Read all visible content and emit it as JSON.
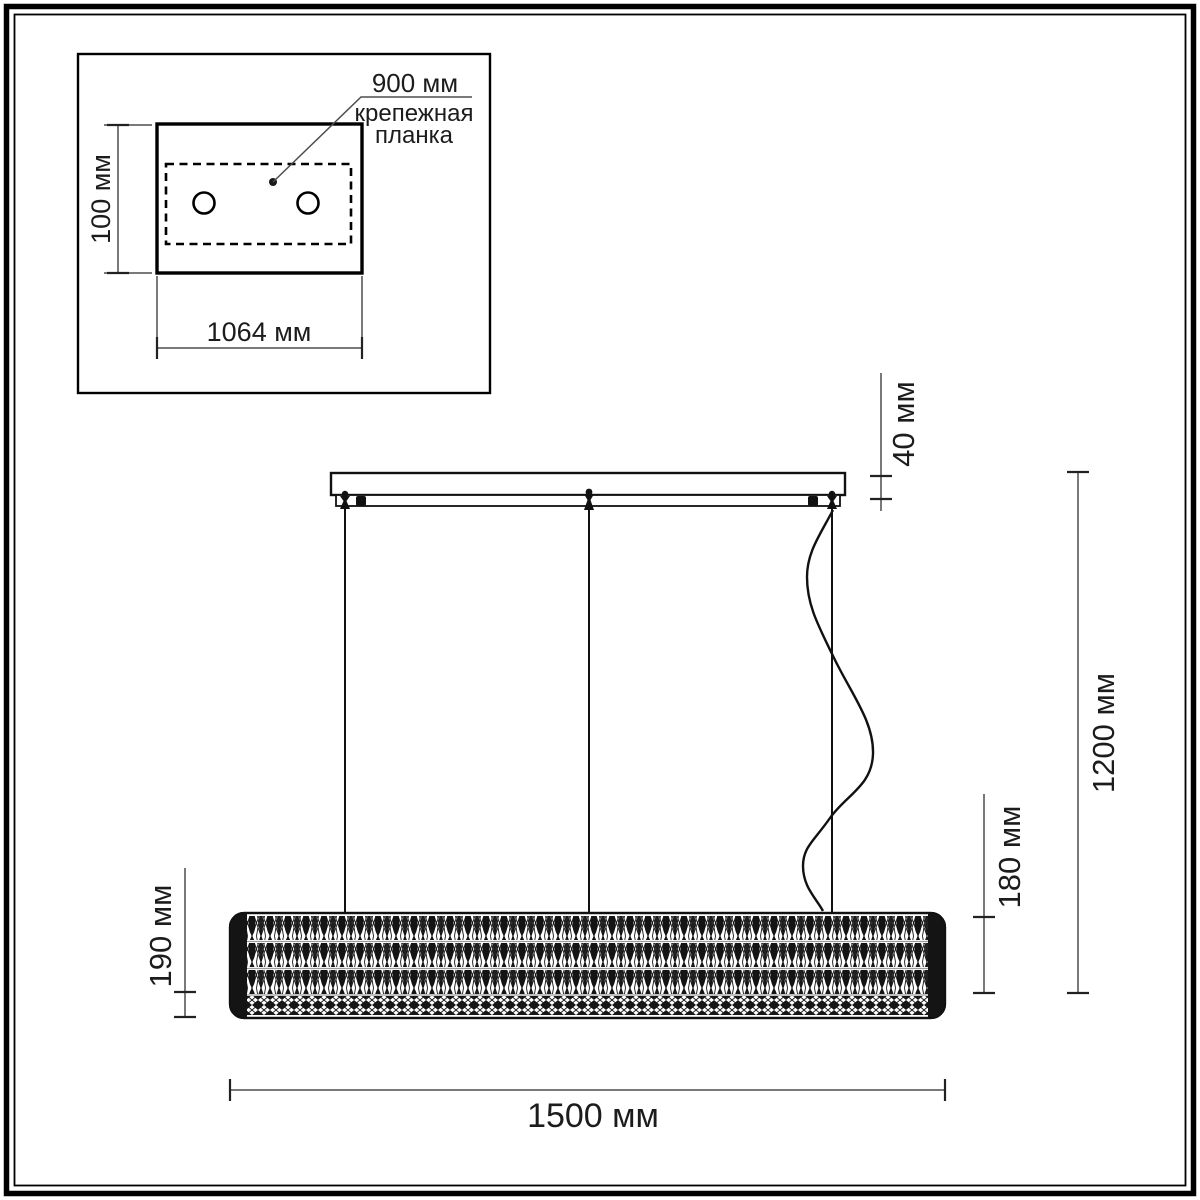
{
  "drawing": {
    "type": "technical-dimension-diagram",
    "subject": "linear crystal pendant chandelier",
    "units": "мм",
    "inset": {
      "height_label": "100 мм",
      "width_label": "1064 мм",
      "leader_value": "900 мм",
      "leader_caption_line1": "крепежная",
      "leader_caption_line2": "планка",
      "mount_holes": 2
    },
    "main": {
      "canopy_height_label": "40 мм",
      "overall_drop_label": "1200 мм",
      "shade_height_right_label": "180 мм",
      "shade_height_left_label": "190 мм",
      "length_label": "1500 мм",
      "suspension_cables": 3
    },
    "colors": {
      "ink": "#1a1a1a",
      "dim_line": "#4d4d4d",
      "background": "#ffffff"
    }
  }
}
